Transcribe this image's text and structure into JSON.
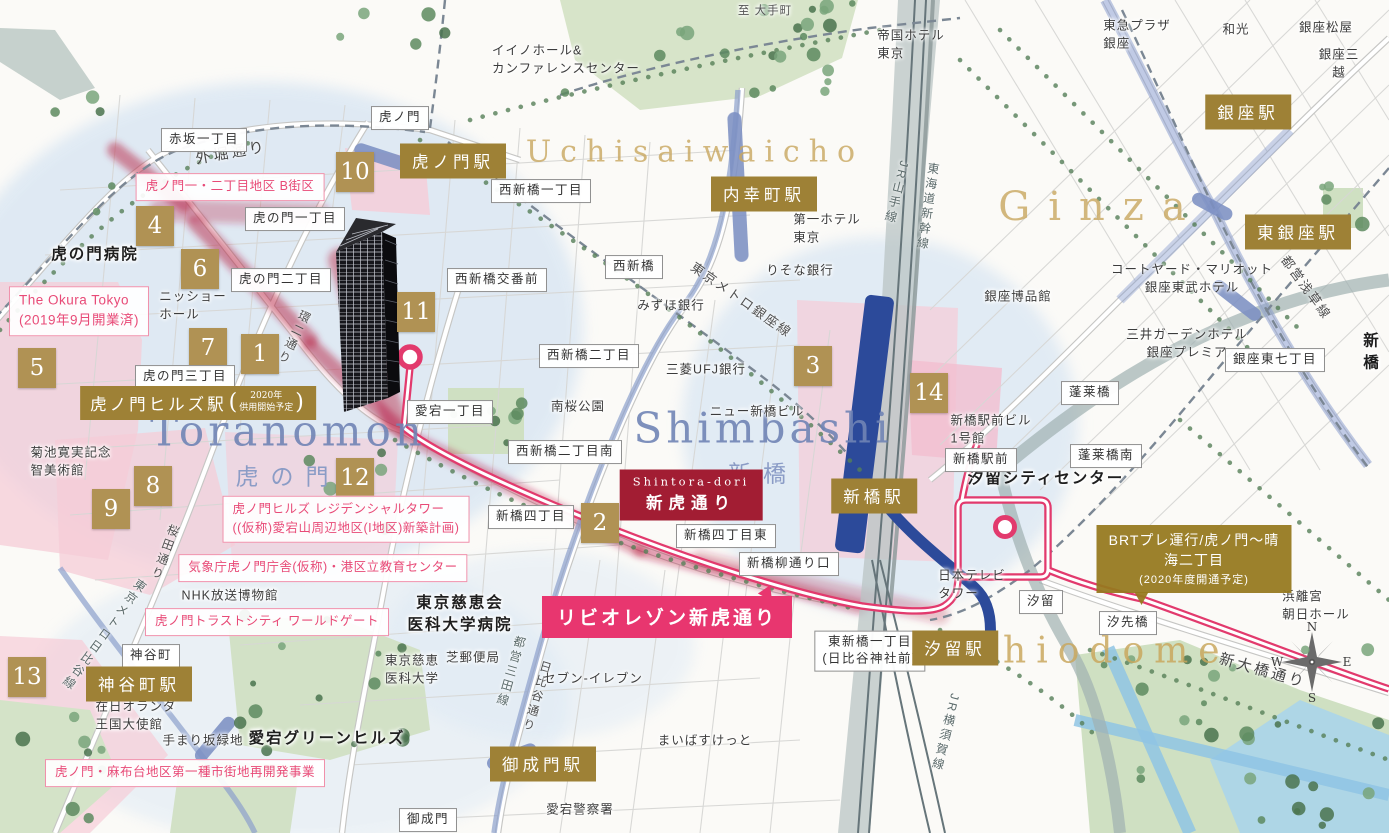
{
  "map": {
    "colors": {
      "station_gold": "#9e8136",
      "badge_gold": "#b09254",
      "route_pink": "#e23a6d",
      "banner_pink": "#e8366f",
      "shintora_red": "#a21d33",
      "pink_label": "#e84a77",
      "area_gold": "#c9a75e",
      "area_blue": "#7084b5",
      "metro_blue": "#7d90c3",
      "jr_gray": "#66757a"
    },
    "area_titles": {
      "uchisaiwaicho": {
        "en": "Uchisaiwaicho"
      },
      "ginza": {
        "en": "Ginza"
      },
      "toranomon": {
        "en": "Toranomon",
        "ja": "虎の門"
      },
      "shimbashi": {
        "en": "Shimbashi",
        "ja": "新橋"
      },
      "shiodome": {
        "en": "Shiodome"
      }
    },
    "hills_station": {
      "name": "虎ノ門ヒルズ駅",
      "sub1": "2020年",
      "sub2": "供用開始予定"
    },
    "shintora_sign": {
      "en": "Shintora-dori",
      "ja": "新虎通り"
    },
    "brt_sign": {
      "line1": "BRTプレ運行/虎ノ門〜晴海二丁目",
      "line2": "(2020年度開通予定)"
    },
    "banner": {
      "text": "リビオレゾン新虎通り"
    },
    "compass": {
      "n": "N",
      "e": "E",
      "s": "S",
      "w": "W"
    },
    "labels": [
      {
        "n": "station-toranomon",
        "cls": "station",
        "text": "虎ノ門駅",
        "x": 453,
        "y": 161
      },
      {
        "n": "station-uchisaiwaicho",
        "cls": "station",
        "text": "内幸町駅",
        "x": 764,
        "y": 194
      },
      {
        "n": "station-ginza",
        "cls": "station",
        "text": "銀座駅",
        "x": 1248,
        "y": 112
      },
      {
        "n": "station-higashi-ginza",
        "cls": "station",
        "text": "東銀座駅",
        "x": 1298,
        "y": 232
      },
      {
        "n": "station-shimbashi",
        "cls": "station",
        "text": "新橋駅",
        "x": 874,
        "y": 496
      },
      {
        "n": "station-shiodome",
        "cls": "station",
        "text": "汐留駅",
        "x": 955,
        "y": 648
      },
      {
        "n": "station-kamiyacho",
        "cls": "station",
        "text": "神谷町駅",
        "x": 139,
        "y": 684
      },
      {
        "n": "station-onarimon",
        "cls": "station",
        "text": "御成門駅",
        "x": 543,
        "y": 764
      },
      {
        "n": "badge-1",
        "cls": "badge",
        "text": "1",
        "x": 260,
        "y": 354
      },
      {
        "n": "badge-2",
        "cls": "badge",
        "text": "2",
        "x": 600,
        "y": 523
      },
      {
        "n": "badge-3",
        "cls": "badge",
        "text": "3",
        "x": 813,
        "y": 366
      },
      {
        "n": "badge-4",
        "cls": "badge",
        "text": "4",
        "x": 155,
        "y": 226
      },
      {
        "n": "badge-5",
        "cls": "badge",
        "text": "5",
        "x": 37,
        "y": 368
      },
      {
        "n": "badge-6",
        "cls": "badge",
        "text": "6",
        "x": 200,
        "y": 269
      },
      {
        "n": "badge-7",
        "cls": "badge",
        "text": "7",
        "x": 208,
        "y": 348
      },
      {
        "n": "badge-8",
        "cls": "badge",
        "text": "8",
        "x": 153,
        "y": 486
      },
      {
        "n": "badge-9",
        "cls": "badge",
        "text": "9",
        "x": 111,
        "y": 509
      },
      {
        "n": "badge-10",
        "cls": "badge",
        "text": "10",
        "x": 355,
        "y": 172
      },
      {
        "n": "badge-11",
        "cls": "badge",
        "text": "11",
        "x": 416,
        "y": 312
      },
      {
        "n": "badge-12",
        "cls": "badge",
        "text": "12",
        "x": 355,
        "y": 478
      },
      {
        "n": "badge-13",
        "cls": "badge",
        "text": "13",
        "x": 27,
        "y": 677
      },
      {
        "n": "badge-14",
        "cls": "badge",
        "text": "14",
        "x": 929,
        "y": 393
      },
      {
        "n": "sign-akasaka-1",
        "cls": "whitebox",
        "text": "赤坂一丁目",
        "x": 204,
        "y": 140
      },
      {
        "n": "sign-toranomon",
        "cls": "whitebox",
        "text": "虎ノ門",
        "x": 400,
        "y": 118
      },
      {
        "n": "sign-toranomon-1",
        "cls": "whitebox",
        "text": "虎の門一丁目",
        "x": 295,
        "y": 219
      },
      {
        "n": "sign-toranomon-2",
        "cls": "whitebox",
        "text": "虎の門二丁目",
        "x": 281,
        "y": 280
      },
      {
        "n": "sign-toranomon-3",
        "cls": "whitebox",
        "text": "虎の門三丁目",
        "x": 185,
        "y": 377
      },
      {
        "n": "sign-nishishimbashi-1",
        "cls": "whitebox",
        "text": "西新橋一丁目",
        "x": 541,
        "y": 191
      },
      {
        "n": "sign-nishishimbashi",
        "cls": "whitebox",
        "text": "西新橋",
        "x": 634,
        "y": 267
      },
      {
        "n": "sign-nishishimbashi-koban",
        "cls": "whitebox",
        "text": "西新橋交番前",
        "x": 497,
        "y": 280
      },
      {
        "n": "sign-nishishimbashi-2",
        "cls": "whitebox",
        "text": "西新橋二丁目",
        "x": 589,
        "y": 356
      },
      {
        "n": "sign-nishishimbashi-2-minami",
        "cls": "whitebox",
        "text": "西新橋二丁目南",
        "x": 565,
        "y": 452
      },
      {
        "n": "sign-atago-1",
        "cls": "whitebox",
        "text": "愛宕一丁目",
        "x": 450,
        "y": 412
      },
      {
        "n": "sign-shimbashi-4",
        "cls": "whitebox",
        "text": "新橋四丁目",
        "x": 531,
        "y": 517
      },
      {
        "n": "sign-shimbashi-4-higashi",
        "cls": "whitebox",
        "text": "新橋四丁目東",
        "x": 726,
        "y": 536
      },
      {
        "n": "sign-yanagi-dori-guchi",
        "cls": "whitebox",
        "text": "新橋柳通り口",
        "x": 789,
        "y": 564
      },
      {
        "n": "sign-higashi-shimbashi-1",
        "cls": "whitebox",
        "text": "東新橋一丁目\n(日比谷神社前)",
        "x": 870,
        "y": 651
      },
      {
        "n": "sign-shiodome",
        "cls": "whitebox",
        "text": "汐留",
        "x": 1041,
        "y": 602
      },
      {
        "n": "sign-shiosaibashi",
        "cls": "whitebox",
        "text": "汐先橋",
        "x": 1128,
        "y": 623
      },
      {
        "n": "sign-horaibashi",
        "cls": "whitebox",
        "text": "蓬莱橋",
        "x": 1090,
        "y": 393
      },
      {
        "n": "sign-horaibashi-minami",
        "cls": "whitebox",
        "text": "蓬莱橋南",
        "x": 1106,
        "y": 456
      },
      {
        "n": "sign-shimbashi-ekimae",
        "cls": "whitebox",
        "text": "新橋駅前",
        "x": 981,
        "y": 460
      },
      {
        "n": "sign-ginza-higashi-7",
        "cls": "whitebox",
        "text": "銀座東七丁目",
        "x": 1275,
        "y": 360
      },
      {
        "n": "sign-kamiyacho",
        "cls": "whitebox",
        "text": "神谷町",
        "x": 151,
        "y": 656
      },
      {
        "n": "sign-onarimon",
        "cls": "whitebox",
        "text": "御成門",
        "x": 428,
        "y": 820
      },
      {
        "n": "poi-toranomon-hospital",
        "cls": "place bold",
        "text": "虎の門病院",
        "x": 95,
        "y": 255
      },
      {
        "n": "poi-nissho-hall",
        "cls": "place left",
        "text": "ニッショー\nホール",
        "x": 193,
        "y": 306
      },
      {
        "n": "poi-kikuchi-museum",
        "cls": "place left",
        "text": "菊池寛実記念\n智美術館",
        "x": 71,
        "y": 462
      },
      {
        "n": "poi-iino-hall",
        "cls": "place left",
        "text": "イイノホール&\nカンファレンスセンター",
        "x": 566,
        "y": 60
      },
      {
        "n": "poi-to-otemachi",
        "cls": "place sm",
        "text": "至 大手町",
        "x": 765,
        "y": 11
      },
      {
        "n": "poi-imperial-hotel",
        "cls": "place left",
        "text": "帝国ホテル\n東京",
        "x": 911,
        "y": 45
      },
      {
        "n": "poi-tokyu-plaza",
        "cls": "place left",
        "text": "東急プラザ\n銀座",
        "x": 1137,
        "y": 35
      },
      {
        "n": "poi-wako",
        "cls": "place",
        "text": "和光",
        "x": 1236,
        "y": 30
      },
      {
        "n": "poi-ginza-matsuya",
        "cls": "place",
        "text": "銀座松屋",
        "x": 1326,
        "y": 28
      },
      {
        "n": "poi-ginza-mitsukoshi",
        "cls": "place",
        "text": "銀座三越",
        "x": 1339,
        "y": 64
      },
      {
        "n": "poi-resona-bank",
        "cls": "place",
        "text": "りそな銀行",
        "x": 800,
        "y": 271
      },
      {
        "n": "poi-daiichi-hotel",
        "cls": "place left",
        "text": "第一ホテル\n東京",
        "x": 827,
        "y": 229
      },
      {
        "n": "poi-mizuho-bank",
        "cls": "place",
        "text": "みずほ銀行",
        "x": 671,
        "y": 306
      },
      {
        "n": "poi-mufg-bank",
        "cls": "place",
        "text": "三菱UFJ銀行",
        "x": 706,
        "y": 370
      },
      {
        "n": "poi-new-shimbashi-bldg",
        "cls": "place",
        "text": "ニュー新橋ビル",
        "x": 757,
        "y": 412
      },
      {
        "n": "poi-minamisakura-park",
        "cls": "place",
        "text": "南桜公園",
        "x": 578,
        "y": 407
      },
      {
        "n": "poi-hakuhinkan",
        "cls": "place",
        "text": "銀座博品館",
        "x": 1018,
        "y": 297
      },
      {
        "n": "poi-courtyard-marriott",
        "cls": "place",
        "text": "コートヤード・マリオット\n銀座東武ホテル",
        "x": 1192,
        "y": 279
      },
      {
        "n": "poi-mitsui-garden",
        "cls": "place",
        "text": "三井ガーデンホテル\n銀座プレミア",
        "x": 1187,
        "y": 344
      },
      {
        "n": "poi-shimbashi-ekimae-bldg",
        "cls": "place left",
        "text": "新橋駅前ビル\n1号館",
        "x": 991,
        "y": 430
      },
      {
        "n": "poi-shiodome-city-center",
        "cls": "place bold",
        "text": "汐留シティセンター",
        "x": 1046,
        "y": 479
      },
      {
        "n": "poi-nittele-tower",
        "cls": "place left",
        "text": "日本テレビ\nタワー",
        "x": 972,
        "y": 585
      },
      {
        "n": "poi-hamarikyu-asahi-hall",
        "cls": "place left",
        "text": "浜離宮\n朝日ホール",
        "x": 1316,
        "y": 606
      },
      {
        "n": "poi-nhk-museum",
        "cls": "place",
        "text": "NHK放送博物館",
        "x": 230,
        "y": 596
      },
      {
        "n": "poi-dutch-embassy",
        "cls": "place left",
        "text": "在日オランダ\n王国大使館",
        "x": 136,
        "y": 716
      },
      {
        "n": "poi-temarizaka-ryokuchi",
        "cls": "place",
        "text": "手まり坂緑地",
        "x": 203,
        "y": 741
      },
      {
        "n": "poi-atago-green-hills",
        "cls": "place bold",
        "text": "愛宕グリーンヒルズ",
        "x": 327,
        "y": 739
      },
      {
        "n": "poi-jikei-hospital",
        "cls": "place bold",
        "text": "東京慈恵会\n医科大学病院",
        "x": 460,
        "y": 614
      },
      {
        "n": "poi-jikei-university",
        "cls": "place left",
        "text": "東京慈恵\n医科大学",
        "x": 412,
        "y": 670
      },
      {
        "n": "poi-shiba-post-office",
        "cls": "place",
        "text": "芝郵便局",
        "x": 473,
        "y": 658
      },
      {
        "n": "poi-seven-eleven",
        "cls": "place",
        "text": "セブン-イレブン",
        "x": 593,
        "y": 679
      },
      {
        "n": "poi-maibasuketto",
        "cls": "place",
        "text": "まいばすけっと",
        "x": 705,
        "y": 741
      },
      {
        "n": "poi-atago-police",
        "cls": "place",
        "text": "愛宕警察署",
        "x": 580,
        "y": 810
      },
      {
        "n": "poi-shimbashi-edge",
        "cls": "place bold",
        "text": "新橋",
        "x": 1372,
        "y": 352
      },
      {
        "n": "project-toranomon-1-2-b",
        "cls": "pinkbox",
        "text": "虎ノ門一・二丁目地区 B街区",
        "x": 230,
        "y": 187
      },
      {
        "n": "project-okura-tokyo",
        "cls": "pinkbox left big",
        "text": "The Okura Tokyo\n(2019年9月開業済)",
        "x": 79,
        "y": 311
      },
      {
        "n": "project-residential-tower",
        "cls": "pinkbox left",
        "text": "虎ノ門ヒルズ レジデンシャルタワー\n((仮称)愛宕山周辺地区(I地区)新築計画)",
        "x": 346,
        "y": 519
      },
      {
        "n": "project-kishocho",
        "cls": "pinkbox",
        "text": "気象庁虎ノ門庁舎(仮称)・港区立教育センター",
        "x": 323,
        "y": 568
      },
      {
        "n": "project-trust-city",
        "cls": "pinkbox",
        "text": "虎ノ門トラストシティ ワールドゲート",
        "x": 267,
        "y": 622
      },
      {
        "n": "project-azabudai",
        "cls": "pinkbox",
        "text": "虎ノ門・麻布台地区第一種市街地再開発事業",
        "x": 185,
        "y": 773
      },
      {
        "n": "rail-jr-yamanote",
        "cls": "raillbl",
        "text": "JR山手線",
        "x": 897,
        "y": 193,
        "rot": 14
      },
      {
        "n": "rail-tokaido-shinkansen",
        "cls": "raillbl",
        "text": "東海道新幹線",
        "x": 928,
        "y": 207,
        "rot": 8
      },
      {
        "n": "rail-jr-yokosuka",
        "cls": "raillbl",
        "text": "JR横須賀線",
        "x": 946,
        "y": 733,
        "rot": 14
      },
      {
        "n": "rail-toei-mita",
        "cls": "raillbl",
        "text": "都営三田線",
        "x": 511,
        "y": 672,
        "rot": 16
      },
      {
        "n": "road-hibiya-dori",
        "cls": "raillbl road",
        "text": "日比谷通り",
        "x": 537,
        "y": 697,
        "rot": 16
      },
      {
        "n": "road-sakurada-dori",
        "cls": "raillbl road",
        "text": "桜田通り",
        "x": 165,
        "y": 553,
        "rot": 20
      },
      {
        "n": "rail-metro-hibiya",
        "cls": "raillbl",
        "text": "東京メトロ日比谷線",
        "x": 104,
        "y": 635,
        "rot": 36
      },
      {
        "n": "road-kanni-dori",
        "cls": "raillbl road",
        "text": "環二通り",
        "x": 294,
        "y": 338,
        "rot": 26
      },
      {
        "n": "rail-metro-ginza",
        "cls": "roadlbl",
        "text": "東京メトロ銀座線",
        "x": 742,
        "y": 299,
        "rot": 35
      },
      {
        "n": "rail-toei-asakusa",
        "cls": "roadlbl",
        "text": "都営浅草線",
        "x": 1307,
        "y": 287,
        "rot": 54
      },
      {
        "n": "road-shin-ohashi-dori",
        "cls": "roadlbl big",
        "text": "新大橋通り",
        "x": 1263,
        "y": 670,
        "rot": 16
      },
      {
        "n": "road-sotobori-dori",
        "cls": "roadlbl big",
        "text": "外堀通り",
        "x": 231,
        "y": 152,
        "rot": -10
      }
    ]
  }
}
